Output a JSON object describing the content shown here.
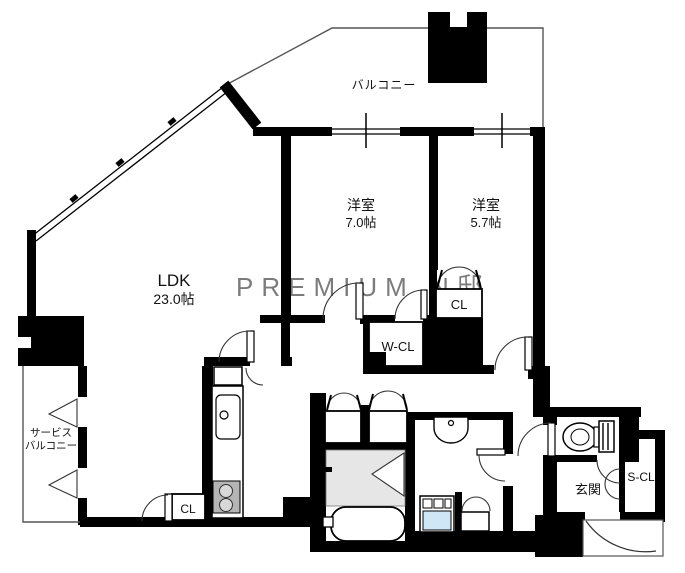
{
  "watermark": "PREMIUM N邸",
  "labels": {
    "balcony": "バルコニー",
    "bedroom1_name": "洋室",
    "bedroom1_size": "7.0帖",
    "bedroom2_name": "洋室",
    "bedroom2_size": "5.7帖",
    "ldk_name": "LDK",
    "ldk_size": "23.0帖",
    "walk_in_closet": "W-CL",
    "closet_bedroom2": "CL",
    "closet_ldk": "CL",
    "shoe_closet": "S-CL",
    "entrance": "玄関",
    "service_balcony_line1": "サービス",
    "service_balcony_line2": "バルコニー"
  },
  "colors": {
    "wall": "#000000",
    "shower_floor": "#e6e6e6",
    "stove": "#b5b5b5",
    "burner": "#d8d8d8",
    "washer": "#cfe6f7",
    "watermark": "#caccd3"
  }
}
